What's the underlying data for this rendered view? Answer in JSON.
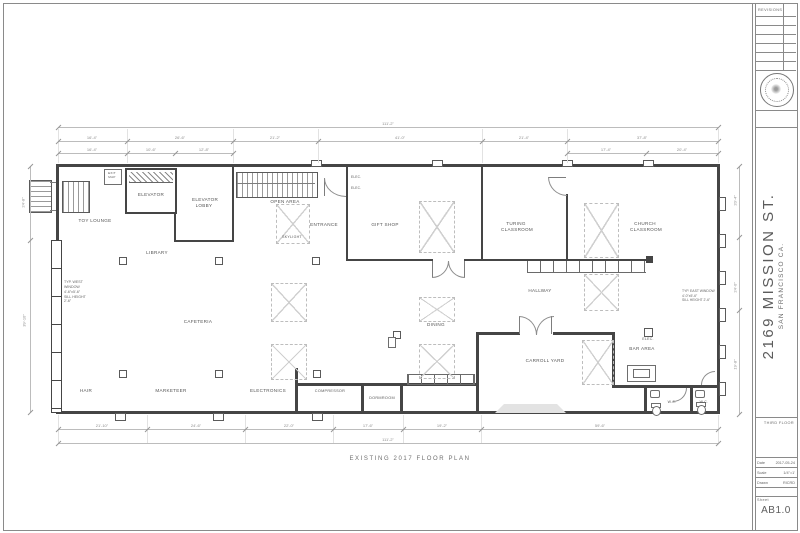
{
  "caption": "EXISTING 2017 FLOOR PLAN",
  "titleblock": {
    "revisions": "REVISIONS",
    "address": "2169 MISSION ST.",
    "city": "SAN FRANCISCO CA.",
    "floor": "THIRD FLOOR",
    "date_label": "Date",
    "date": "2017-05-24",
    "scale_label": "Scale",
    "scale": "1/4\"=1'",
    "drawn_label": "Drawn",
    "drawn": "RICRD",
    "sheet_label": "Sheet",
    "sheet": "AB1.0"
  },
  "rooms": {
    "toy_lounge": "TOY LOUNGE",
    "elevator": "ELEVATOR",
    "elevator_lobby": "ELEVATOR LOBBY",
    "library": "LIBRARY",
    "open_area": "OPEN AREA",
    "entrance": "ENTRANCE",
    "skylight": "SKYLIGHT",
    "gift_shop": "GIFT SHOP",
    "turing_classroom": "TURING CLASSROOM",
    "church_classroom": "CHURCH CLASSROOM",
    "hallway": "HALLWAY",
    "cafeteria": "CAFETERIA",
    "dining": "DINING",
    "carroll_yard": "CARROLL YARD",
    "bar_area": "BAR AREA",
    "elec": "ELEC.",
    "elec_a": "ELEC.",
    "elec_b": "ELEC.",
    "wc_left": "W.C.",
    "wc_right": "W.C.",
    "hair": "HAIR",
    "marketeer": "MARKETEER",
    "electronics": "ELECTRONICS",
    "compressor": "COMPRESSOR",
    "dormroom": "DORMROOM",
    "exit_map": "EXIT\nMAP"
  },
  "notes": {
    "west_window": "TYP. WEST\nWINDOW\n4'-6\"x5'-6\"\nSILL HEIGHT\n2'-6\"",
    "east_window": "TYP. EAST WINDOW\n4'-0\"x5'-6\"\nSILL HEIGHT 2'-6\""
  },
  "dims": {
    "top_overall": "111'-2\"",
    "top_row": [
      "16'-4\"",
      "26'-6\"",
      "21'-2\"",
      "41'-0\"",
      "21'-4\"",
      "37'-8\""
    ],
    "top_sub_left": [
      "16'-4\"",
      "10'-6\"",
      "12'-8\""
    ],
    "top_sub_right": [
      "17'-4\"",
      "20'-4\""
    ],
    "bottom_row": [
      "21'-10\"",
      "24'-6\"",
      "22'-0\"",
      "17'-6\"",
      "19'-2\"",
      "59'-6\""
    ],
    "bottom_overall": "111'-2\"",
    "left": [
      "24'-8\"",
      "39'-10\""
    ],
    "right": [
      "20'-4\"",
      "24'-0\"",
      "19'-8\""
    ]
  }
}
